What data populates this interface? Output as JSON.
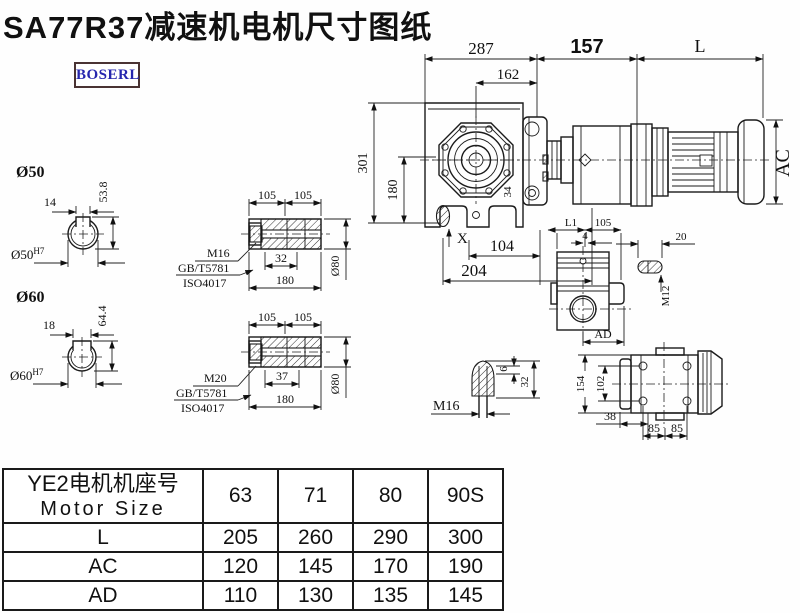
{
  "title": "SA77R37减速机电机尺寸图纸",
  "logo": "BOSERL",
  "colors": {
    "line": "#1b1b1b",
    "logo_text": "#2626ae",
    "logo_border": "#4a3333",
    "background": "#ffffff"
  },
  "main_view": {
    "d287": "287",
    "d162": "162",
    "d157": "157",
    "dL": "L",
    "d301": "301",
    "d180": "180",
    "d34": "34",
    "dX": "X",
    "d104": "104",
    "d204": "204",
    "dAC": "AC"
  },
  "bore50": {
    "title": "Ø50",
    "key_w": "14",
    "height": "53.8",
    "bore": "Ø50",
    "tol": "H7"
  },
  "bore60": {
    "title": "Ø60",
    "key_w": "18",
    "height": "64.4",
    "bore": "Ø60",
    "tol": "H7"
  },
  "shaft1": {
    "d105a": "105",
    "d105b": "105",
    "bolt": "M16",
    "std1": "GB/T5781",
    "std2": "ISO4017",
    "d32": "32",
    "d180": "180",
    "dia": "Ø80"
  },
  "shaft2": {
    "d105a": "105",
    "d105b": "105",
    "bolt": "M20",
    "std1": "GB/T5781",
    "std2": "ISO4017",
    "d37": "37",
    "d180": "180",
    "dia": "Ø80"
  },
  "plug_view": {
    "bolt": "M16",
    "d6": "6",
    "d32": "32"
  },
  "aux_view": {
    "dL1": "L1",
    "d105": "105",
    "d4": "4",
    "dAD": "AD"
  },
  "key_view": {
    "d20": "20",
    "bolt": "M12"
  },
  "rear_view": {
    "d154": "154",
    "d102": "102",
    "d38": "38",
    "d85a": "85",
    "d85b": "85"
  },
  "table": {
    "header_line1": "YE2电机机座号",
    "header_line2": "Motor Size",
    "columns": [
      "63",
      "71",
      "80",
      "90S"
    ],
    "rows": [
      {
        "label": "L",
        "values": [
          "205",
          "260",
          "290",
          "300"
        ]
      },
      {
        "label": "AC",
        "values": [
          "120",
          "145",
          "170",
          "190"
        ]
      },
      {
        "label": "AD",
        "values": [
          "110",
          "130",
          "135",
          "145"
        ]
      }
    ]
  }
}
